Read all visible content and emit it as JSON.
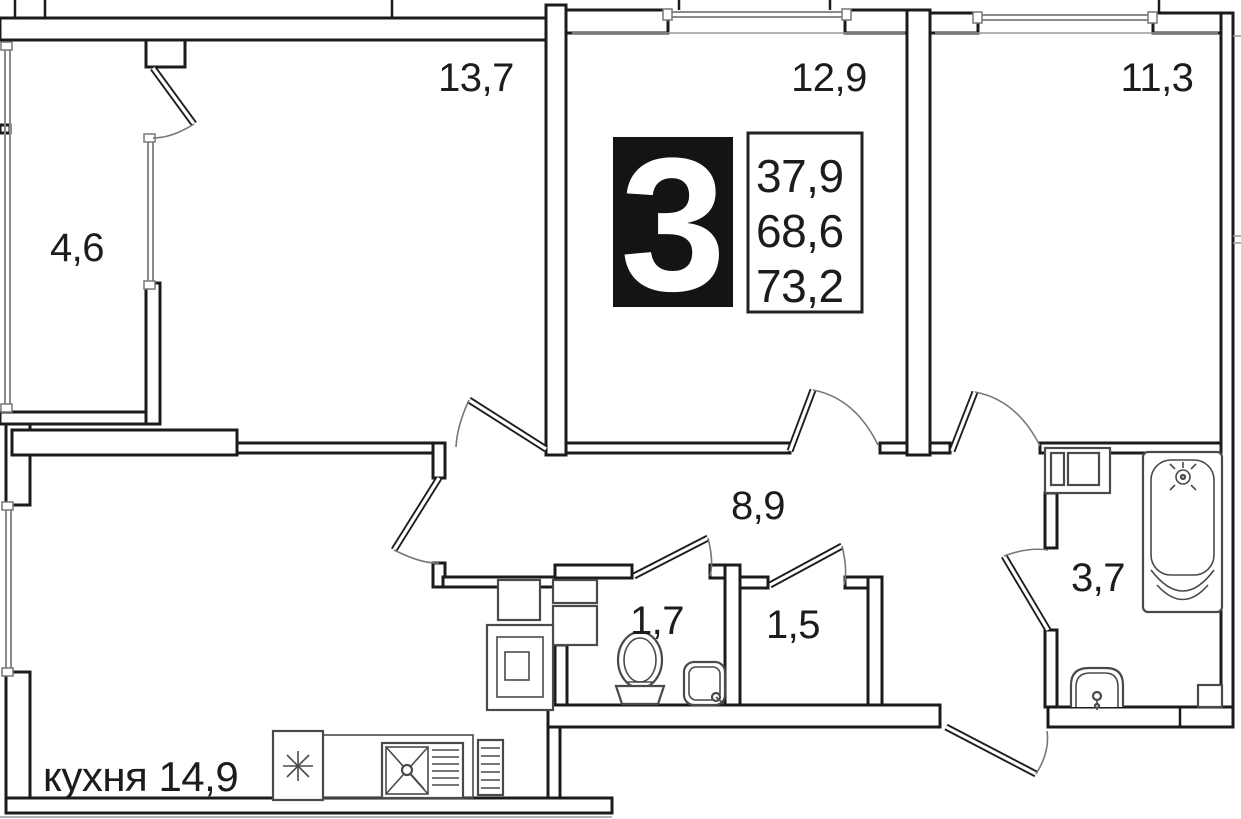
{
  "plan": {
    "title": "apartment-floor-plan",
    "badge": {
      "rooms_count": "3",
      "areas": [
        "37,9",
        "68,6",
        "73,2"
      ]
    },
    "rooms": [
      {
        "id": "bedroom-left",
        "label": "13,7"
      },
      {
        "id": "bedroom-mid",
        "label": "12,9"
      },
      {
        "id": "bedroom-right",
        "label": "11,3"
      },
      {
        "id": "balcony",
        "label": "4,6"
      },
      {
        "id": "hallway",
        "label": "8,9"
      },
      {
        "id": "wc",
        "label": "1,7"
      },
      {
        "id": "storage",
        "label": "1,5"
      },
      {
        "id": "bathroom",
        "label": "3,7"
      },
      {
        "id": "kitchen",
        "label": "кухня 14,9"
      }
    ],
    "colors": {
      "wall": "#1b1b1b",
      "window": "#8a8a8a",
      "badge_bg": "#141414",
      "badge_text": "#ffffff"
    }
  }
}
